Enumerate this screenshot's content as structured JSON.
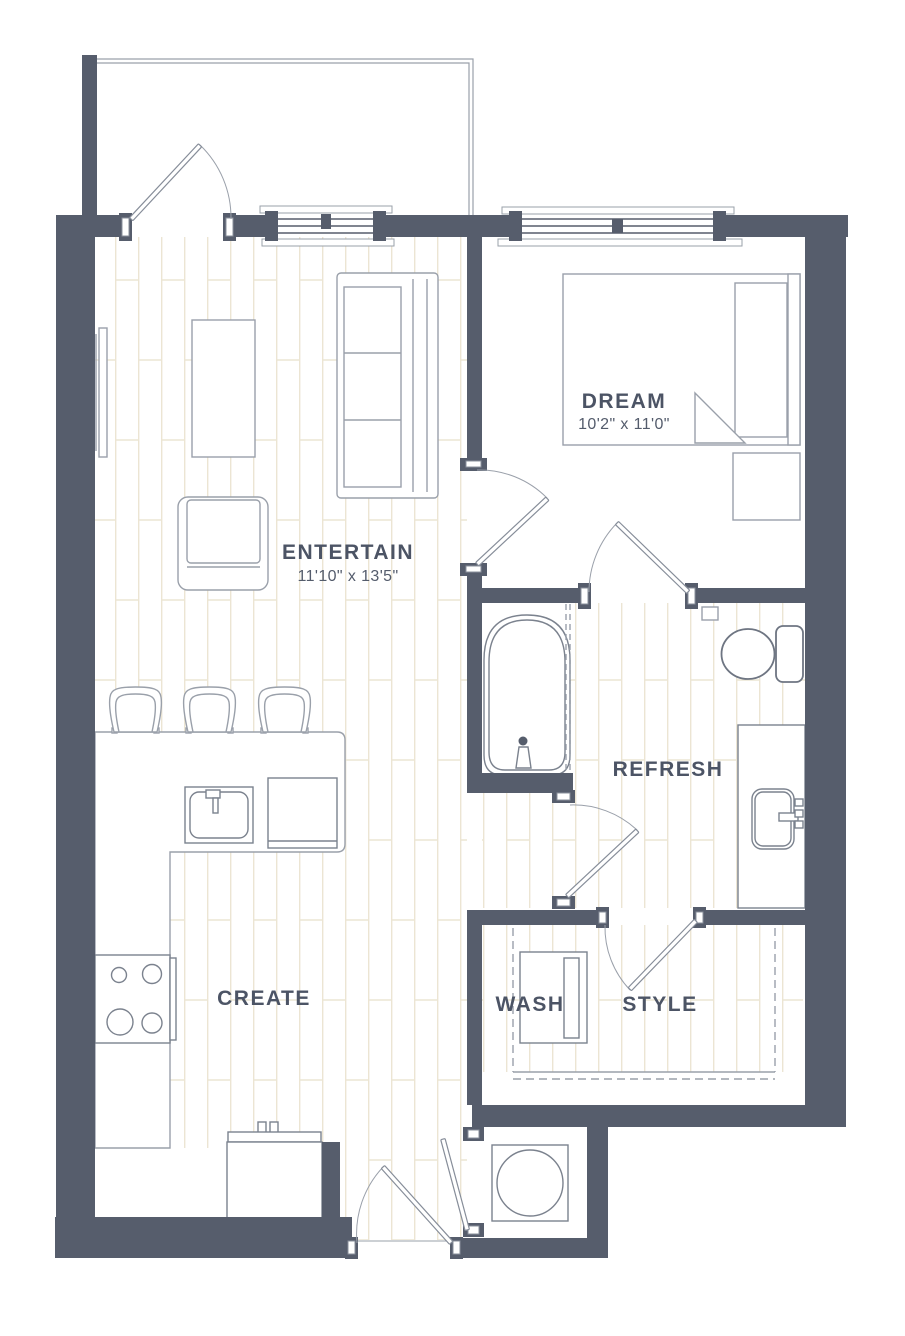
{
  "page": {
    "background": "#ffffff",
    "type": "apartment-floor-plan"
  },
  "palette": {
    "wall": "#565d6c",
    "furniture_line": "#9aa0aa",
    "fixture_line": "#7b828e",
    "floor_plank_line": "#ece5d3",
    "label_text": "#4c5465"
  },
  "rooms": {
    "entertain": {
      "label": "ENTERTAIN",
      "dimensions": "11'10\" x 13'5\""
    },
    "dream": {
      "label": "DREAM",
      "dimensions": "10'2\" x 11'0\""
    },
    "refresh": {
      "label": "REFRESH"
    },
    "create": {
      "label": "CREATE"
    },
    "wash": {
      "label": "WASH"
    },
    "style": {
      "label": "STYLE"
    }
  },
  "fixtures": [
    "balcony",
    "balcony-door",
    "living-window",
    "bedroom-window",
    "tv",
    "coffee-table",
    "sofa",
    "armchair",
    "kitchen-island",
    "bar-stools",
    "kitchen-sink",
    "dishwasher",
    "stove",
    "refrigerator",
    "bed",
    "pillow",
    "nightstand",
    "bathtub",
    "shower-curtain",
    "toilet",
    "vanity-sink",
    "washer-dryer",
    "closet-shelf",
    "water-heater",
    "entry-door"
  ]
}
